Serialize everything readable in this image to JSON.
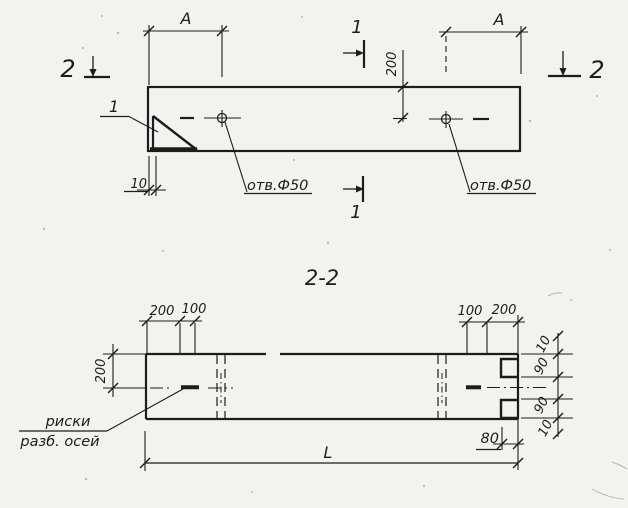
{
  "colors": {
    "paper": "#f3f2ee",
    "ink": "#1c1c1c"
  },
  "plan_view": {
    "section_cut_2_left": {
      "label": "2"
    },
    "section_cut_2_right": {
      "label": "2"
    },
    "section_cut_1_top": {
      "label": "1"
    },
    "section_cut_1_bottom": {
      "label": "1"
    },
    "detail_callout": {
      "label": "1"
    },
    "dim_a_left": {
      "label": "A"
    },
    "dim_a_right": {
      "label": "A"
    },
    "dim_200": {
      "label": "200"
    },
    "dim_10": {
      "label": "10"
    },
    "hole_left": {
      "label": "отв.Ф50"
    },
    "hole_right": {
      "label": "отв.Ф50"
    }
  },
  "section_view": {
    "title": "2-2",
    "dim_chain_top_left": {
      "labels": [
        "200",
        "100"
      ]
    },
    "dim_chain_top_right": {
      "labels": [
        "100",
        "200"
      ]
    },
    "dim_height": {
      "label": "200"
    },
    "dim_stack_right": {
      "labels": [
        "10",
        "90",
        "90",
        "10"
      ]
    },
    "dim_80": {
      "label": "80"
    },
    "dim_length": {
      "label": "L"
    },
    "axis_marks_note": {
      "line1": "риски",
      "line2": "разб. осей"
    }
  }
}
